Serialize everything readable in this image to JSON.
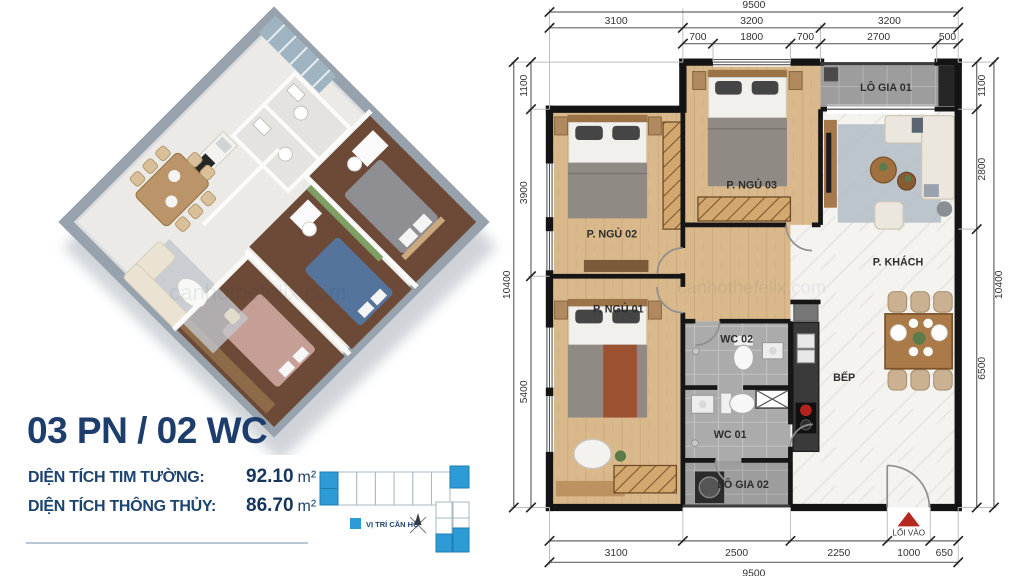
{
  "info": {
    "title": "03 PN / 02 WC",
    "rows": [
      {
        "label": "DIỆN TÍCH TIM TƯỜNG:",
        "value": "92.10",
        "unit": "m²"
      },
      {
        "label": "DIỆN TÍCH THÔNG THỦY:",
        "value": "86.70",
        "unit": "m²"
      }
    ],
    "legend": "VỊ TRÍ CĂN HỘ"
  },
  "plan": {
    "rooms": {
      "bedroom1": "P. NGỦ 01",
      "bedroom2": "P. NGỦ 02",
      "bedroom3": "P. NGỦ 03",
      "living": "P. KHÁCH",
      "kitchen": "BẾP",
      "wc1": "WC 01",
      "wc2": "WC 02",
      "balcony1": "LÔ GIA 01",
      "balcony2": "LÔ GIA 02",
      "entrance": "LỐI VÀO"
    },
    "dims": {
      "top_total": "9500",
      "top_mid": [
        "3100",
        "3200",
        "3200"
      ],
      "top_inner": [
        "700",
        "1800",
        "700",
        "2700",
        "500"
      ],
      "bottom": [
        "3100",
        "2500",
        "2250",
        "1000",
        "650"
      ],
      "bottom_total": "9500",
      "left": [
        "1100",
        "3900",
        "5400"
      ],
      "left_total": "10400",
      "right": [
        "1100",
        "2800",
        "6500"
      ],
      "right_total": "10400"
    }
  },
  "watermark": "canhothefelix.com",
  "colors": {
    "navy": "#1d3e6c",
    "brand_blue": "#2d9bd6",
    "entry_red": "#b5281e"
  }
}
